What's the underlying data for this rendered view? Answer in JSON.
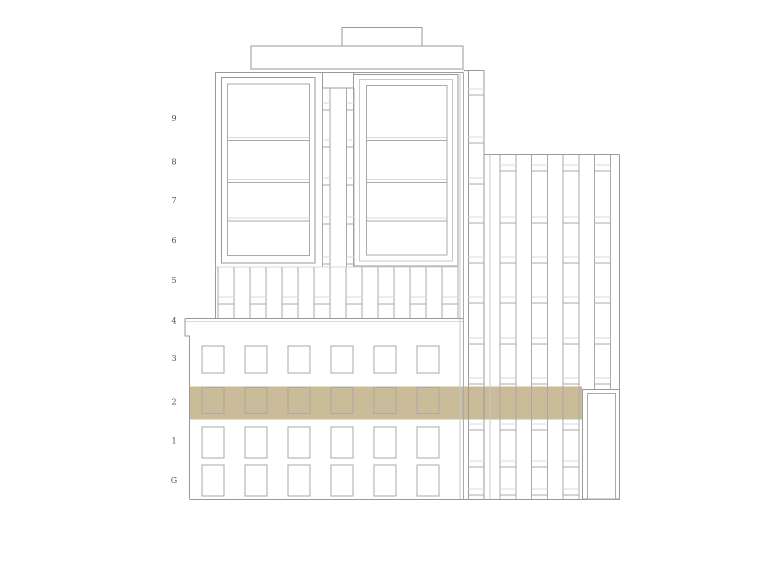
{
  "document": {
    "type": "architectural-elevation",
    "floor_labels": [
      "9",
      "8",
      "7",
      "6",
      "5",
      "4",
      "3",
      "2",
      "1",
      "G"
    ],
    "highlighted_floor": "2",
    "colors": {
      "background": "#ffffff",
      "highlight_band": "#cabb99",
      "line_strong": "#9a9a9a",
      "line_medium": "#a9a9a9",
      "line_light": "#dadada",
      "line_faint": "#c9c9c9",
      "label_text": "#4d4d4d"
    }
  }
}
